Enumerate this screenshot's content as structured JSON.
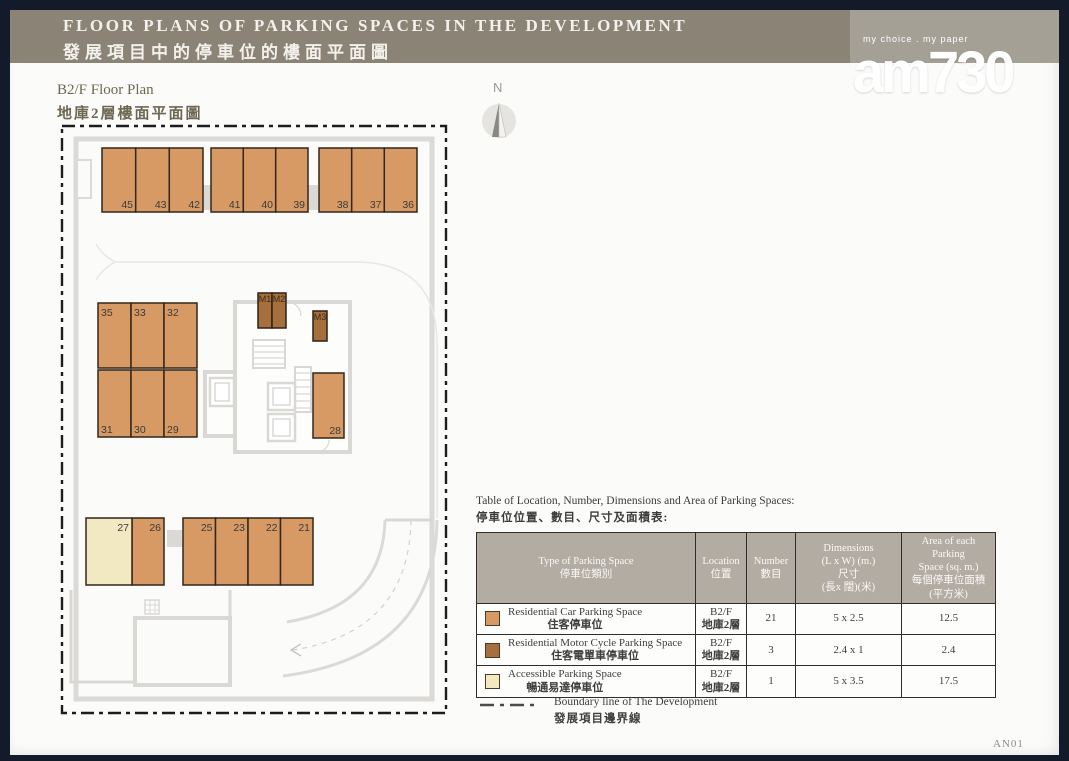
{
  "header": {
    "title_en": "FLOOR PLANS OF PARKING SPACES IN THE DEVELOPMENT",
    "title_zh": "發展項目中的停車位的樓面平面圖",
    "logo": {
      "tagline": "my choice . my paper",
      "name": "am730"
    }
  },
  "plan": {
    "title_en": "B2/F Floor Plan",
    "title_zh": "地庫2層樓面平面圖",
    "north_label": "N",
    "spaces": {
      "top": [
        "45",
        "43",
        "42",
        "41",
        "40",
        "39",
        "38",
        "37",
        "36"
      ],
      "mid_upper": [
        "35",
        "33",
        "32"
      ],
      "mid_lower": [
        "31",
        "30",
        "29"
      ],
      "moto": [
        "M1",
        "M2",
        "M3"
      ],
      "right": "28",
      "bottom": [
        "27",
        "26",
        "25",
        "23",
        "22",
        "21"
      ]
    }
  },
  "table": {
    "title_en": "Table of Location, Number, Dimensions and Area of Parking Spaces:",
    "title_zh": "停車位位置、數目、尺寸及面積表:",
    "columns": {
      "type": "Type of Parking Space\n停車位類別",
      "location": "Location\n位置",
      "number": "Number\n數目",
      "dimensions": "Dimensions\n(L x W) (m.)\n尺寸\n(長x 闊)(米)",
      "area": "Area of each Parking\nSpace (sq. m.)\n每個停車位面積\n(平方米)"
    },
    "rows": [
      {
        "type_en": "Residential Car Parking Space",
        "type_zh": "住客停車位",
        "loc_en": "B2/F",
        "loc_zh": "地庫2層",
        "number": "21",
        "dimensions": "5 x 2.5",
        "area": "12.5",
        "swatch_color": "#d89a64"
      },
      {
        "type_en": "Residential Motor Cycle Parking Space",
        "type_zh": "住客電單車停車位",
        "loc_en": "B2/F",
        "loc_zh": "地庫2層",
        "number": "3",
        "dimensions": "2.4 x 1",
        "area": "2.4",
        "swatch_color": "#a56f3e"
      },
      {
        "type_en": "Accessible Parking Space",
        "type_zh": "暢通易達停車位",
        "loc_en": "B2/F",
        "loc_zh": "地庫2層",
        "number": "1",
        "dimensions": "5 x 3.5",
        "area": "17.5",
        "swatch_color": "#f2e9c3"
      }
    ]
  },
  "legend": {
    "boundary_en": "Boundary line of The Development",
    "boundary_zh": "發展項目邊界線"
  },
  "footer": {
    "page_code": "AN01"
  },
  "colors": {
    "header_bar": "#8b8376",
    "logo_block": "#a4a096",
    "residential_car": "#d89a64",
    "motor_cycle": "#a56f3e",
    "accessible": "#f2e9c3",
    "stall_border": "#33261a",
    "boundary_line": "#1c1c1c",
    "core_gray": "#d9d8d5",
    "table_header_bg": "#b2aca3"
  }
}
